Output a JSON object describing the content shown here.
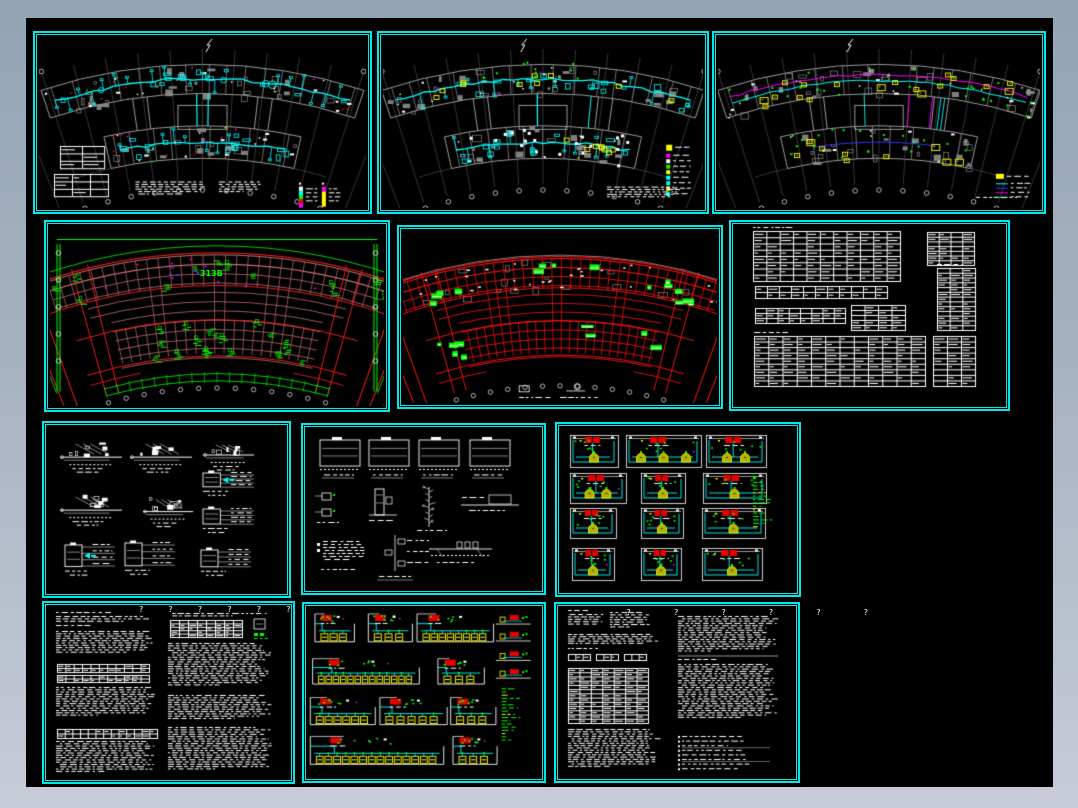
{
  "page": {
    "background_top": "#92a4b6",
    "background_bottom": "#c7ccd8",
    "canvas_background": "#000000",
    "sheet_border_color": "#00e8e8"
  },
  "palette": {
    "cyan": "#00ffff",
    "yellow": "#ffff00",
    "green": "#00ff00",
    "red": "#ff1515",
    "salmon": "#c06e6e",
    "magenta": "#ff00ff",
    "blue": "#4444ff",
    "gray": "#9a9a9a",
    "white": "#ffffff"
  },
  "overlays": {
    "question_row": "?  ?  ?  ?  ?  ?",
    "grid_label": "313B"
  },
  "sheets": [
    {
      "name": "sheet-floor-plan-hvac-1",
      "kind": "fan-plan",
      "variant": "cyan",
      "x": 33,
      "y": 31,
      "w": 339,
      "h": 183,
      "seed": 11,
      "north": 0.52,
      "legend_bars": [
        [
          "#ffffff",
          "#00ffff",
          "#00ff00",
          "#ff0000",
          "#ff00ff"
        ],
        [
          "#ff00ff",
          "#ffff00"
        ]
      ]
    },
    {
      "name": "sheet-floor-plan-hvac-2",
      "kind": "fan-plan",
      "variant": "cyan-yellow",
      "x": 377,
      "y": 31,
      "w": 332,
      "h": 183,
      "seed": 22,
      "north": 0.44,
      "legend_swatches": [
        "#ffff00",
        "#ff00ff",
        "#ffffff",
        "#00ff00",
        "#ffff00",
        "#00ffff",
        "#00ffff",
        "#ffff00",
        "#00ffff"
      ]
    },
    {
      "name": "sheet-floor-plan-piping",
      "kind": "fan-plan",
      "variant": "piping",
      "x": 712,
      "y": 31,
      "w": 334,
      "h": 183,
      "seed": 33,
      "north": 0.41,
      "legend_box": "#ffff00",
      "legend_lines": [
        "#00ffff",
        "#3333ff",
        "#ff00ff",
        "#00ff00"
      ]
    },
    {
      "name": "sheet-floor-plan-red-1",
      "kind": "red-grid",
      "variant": "salmon",
      "x": 44,
      "y": 220,
      "w": 346,
      "h": 192,
      "seed": 44,
      "label": true
    },
    {
      "name": "sheet-floor-plan-red-2",
      "kind": "red-grid",
      "variant": "red",
      "x": 397,
      "y": 225,
      "w": 326,
      "h": 184,
      "seed": 55
    },
    {
      "name": "sheet-schedule-tables",
      "kind": "schedules",
      "x": 729,
      "y": 220,
      "w": 281,
      "h": 191,
      "seed": 66
    },
    {
      "name": "sheet-detail-drawings-1",
      "kind": "details-a",
      "x": 42,
      "y": 421,
      "w": 249,
      "h": 177,
      "seed": 77
    },
    {
      "name": "sheet-detail-drawings-2",
      "kind": "details-b",
      "x": 301,
      "y": 423,
      "w": 245,
      "h": 172,
      "seed": 88
    },
    {
      "name": "sheet-unit-diagrams",
      "kind": "unit-grid",
      "x": 555,
      "y": 422,
      "w": 246,
      "h": 175,
      "seed": 99
    },
    {
      "name": "sheet-spec-notes-1",
      "kind": "notes",
      "variant": "a",
      "x": 42,
      "y": 601,
      "w": 253,
      "h": 183,
      "seed": 110,
      "qrow": "a"
    },
    {
      "name": "sheet-riser-diagrams",
      "kind": "risers",
      "x": 302,
      "y": 602,
      "w": 244,
      "h": 181,
      "seed": 121
    },
    {
      "name": "sheet-spec-notes-2",
      "kind": "notes",
      "variant": "b",
      "x": 554,
      "y": 602,
      "w": 246,
      "h": 181,
      "seed": 132,
      "qrow": "b"
    }
  ]
}
